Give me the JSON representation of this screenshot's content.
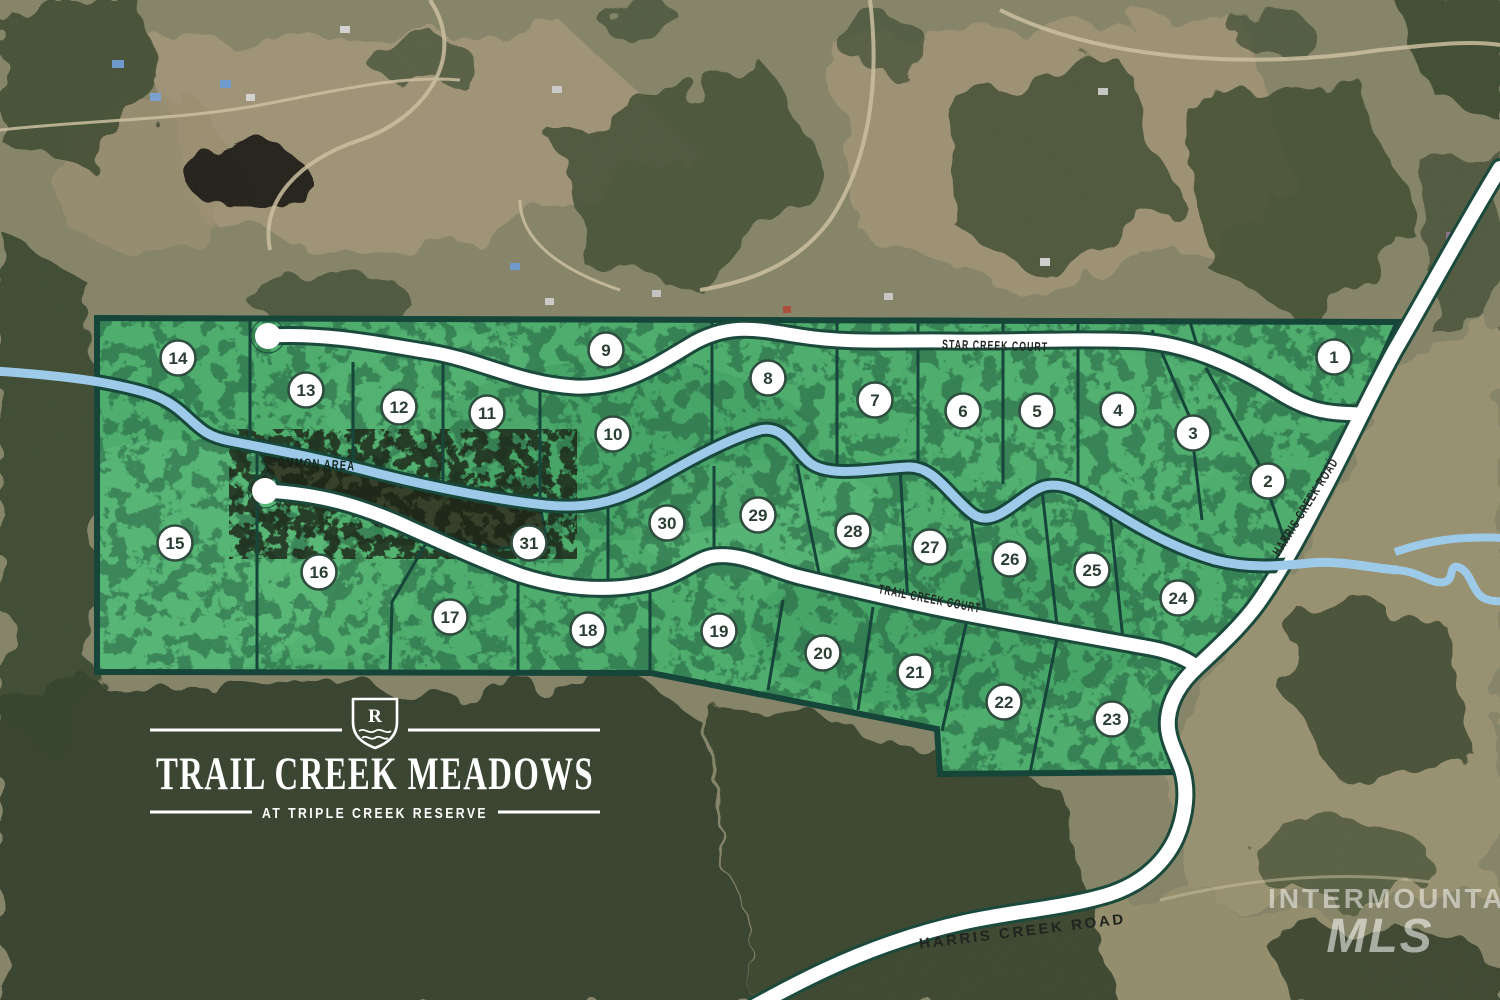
{
  "map": {
    "title": "Trail Creek Meadows plat map",
    "roads": {
      "star_creek_court": "STAR CREEK COURT",
      "trail_creek_court": "TRAIL CREEK COURT",
      "harris_creek_road": "HARRIS CREEK ROAD"
    },
    "labels": {
      "common_area": "COMMON AREA"
    },
    "lots": [
      {
        "number": "1",
        "x": 1334,
        "y": 357
      },
      {
        "number": "2",
        "x": 1268,
        "y": 481
      },
      {
        "number": "3",
        "x": 1193,
        "y": 433
      },
      {
        "number": "4",
        "x": 1118,
        "y": 410
      },
      {
        "number": "5",
        "x": 1037,
        "y": 411
      },
      {
        "number": "6",
        "x": 963,
        "y": 411
      },
      {
        "number": "7",
        "x": 875,
        "y": 400
      },
      {
        "number": "8",
        "x": 768,
        "y": 378
      },
      {
        "number": "9",
        "x": 606,
        "y": 350
      },
      {
        "number": "10",
        "x": 613,
        "y": 434
      },
      {
        "number": "11",
        "x": 487,
        "y": 413
      },
      {
        "number": "12",
        "x": 399,
        "y": 407
      },
      {
        "number": "13",
        "x": 306,
        "y": 390
      },
      {
        "number": "14",
        "x": 178,
        "y": 358
      },
      {
        "number": "15",
        "x": 175,
        "y": 543
      },
      {
        "number": "16",
        "x": 319,
        "y": 572
      },
      {
        "number": "17",
        "x": 450,
        "y": 617
      },
      {
        "number": "18",
        "x": 588,
        "y": 630
      },
      {
        "number": "19",
        "x": 719,
        "y": 631
      },
      {
        "number": "20",
        "x": 823,
        "y": 653
      },
      {
        "number": "21",
        "x": 915,
        "y": 672
      },
      {
        "number": "22",
        "x": 1004,
        "y": 702
      },
      {
        "number": "23",
        "x": 1112,
        "y": 719
      },
      {
        "number": "24",
        "x": 1178,
        "y": 598
      },
      {
        "number": "25",
        "x": 1092,
        "y": 570
      },
      {
        "number": "26",
        "x": 1010,
        "y": 559
      },
      {
        "number": "27",
        "x": 930,
        "y": 547
      },
      {
        "number": "28",
        "x": 853,
        "y": 531
      },
      {
        "number": "29",
        "x": 758,
        "y": 515
      },
      {
        "number": "30",
        "x": 667,
        "y": 523
      },
      {
        "number": "31",
        "x": 529,
        "y": 543
      }
    ],
    "logo": {
      "monogram": "R",
      "title": "TRAIL CREEK MEADOWS",
      "subtitle": "AT TRIPLE CREEK RESERVE"
    },
    "watermark": {
      "line1": "INTERMOUNTAIN",
      "line2": "MLS"
    },
    "colors": {
      "lot_green": "#4fae6e",
      "plat_outline": "#16453a",
      "creek_blue": "#9ccae8",
      "road_white": "#ffffff",
      "common_area_dark": "#35412a"
    }
  }
}
